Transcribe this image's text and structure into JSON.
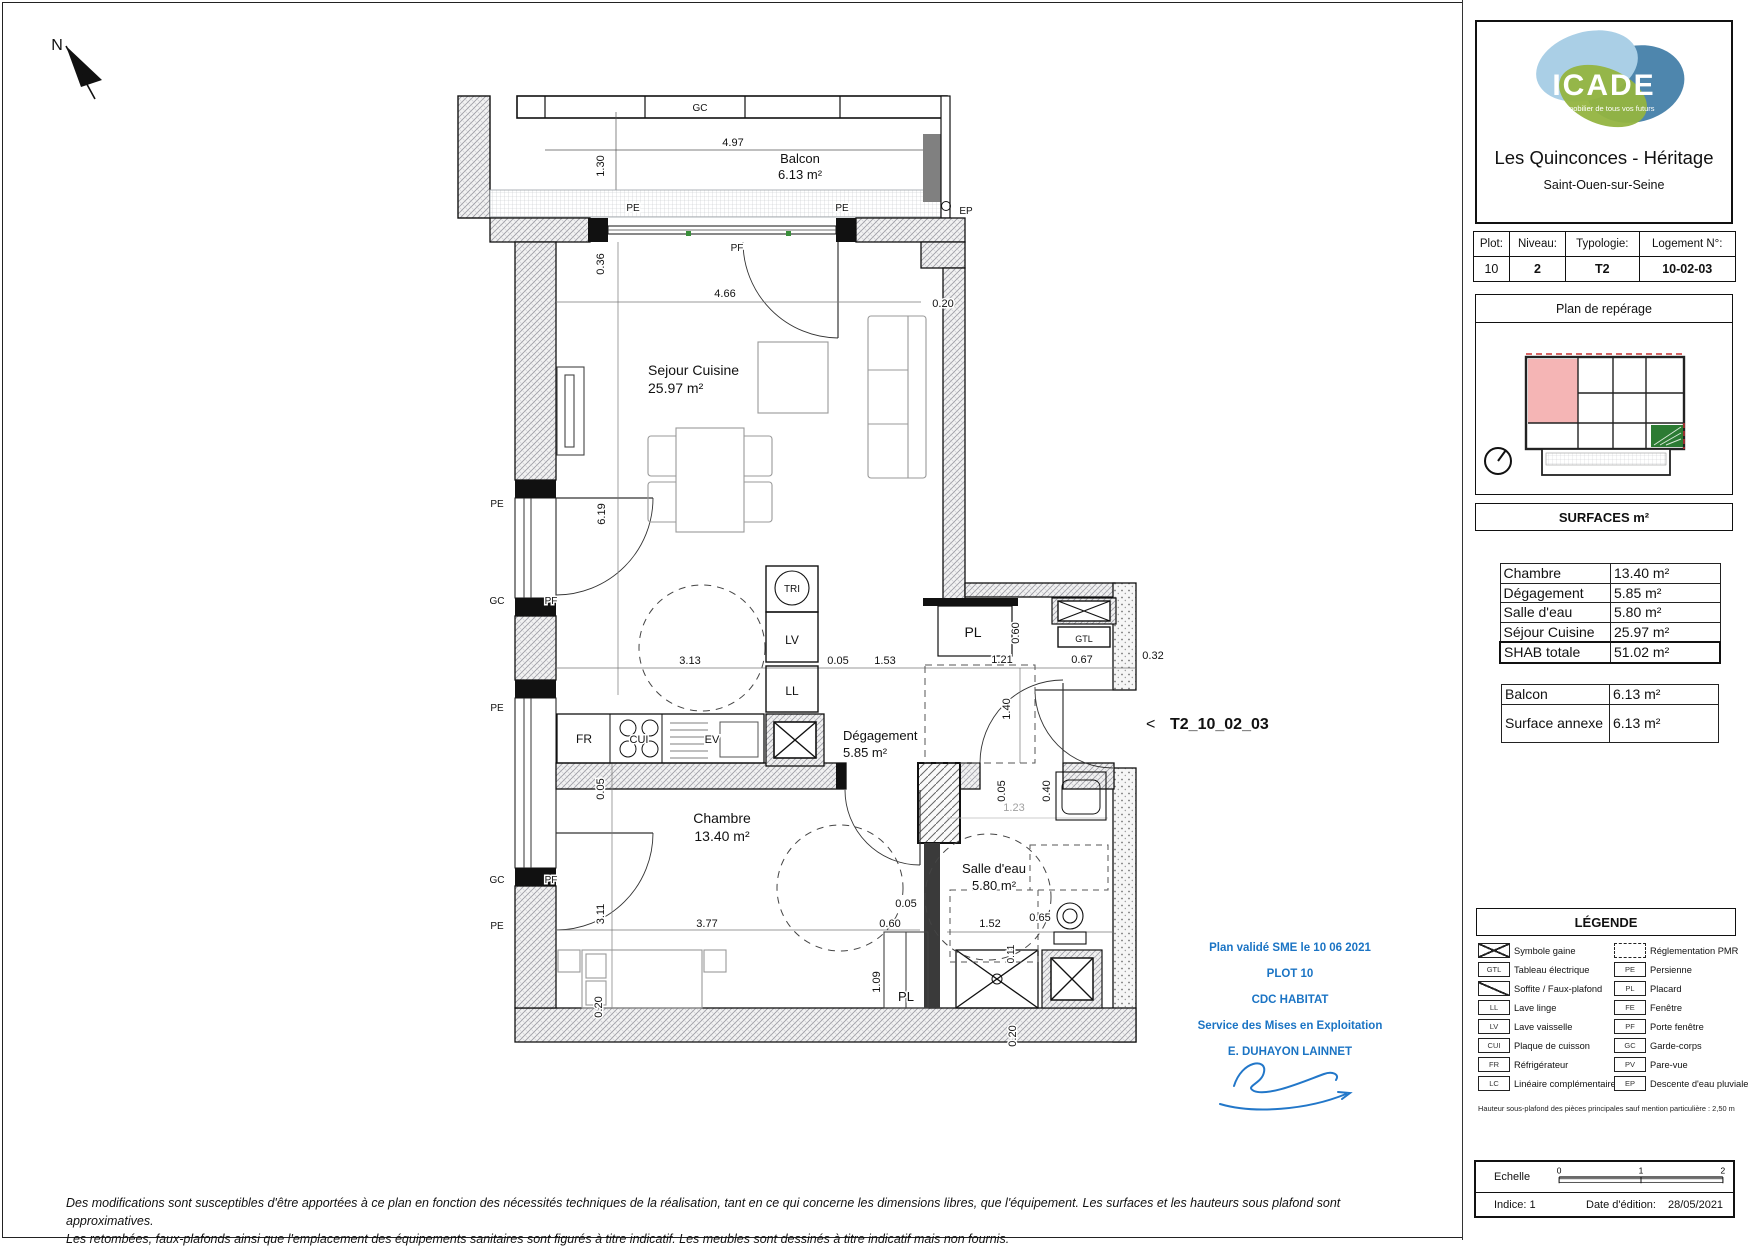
{
  "project": {
    "brand": "ICADE",
    "brand_tagline": "L'immobilier de tous vos futurs",
    "title": "Les Quinconces - Héritage",
    "city": "Saint-Ouen-sur-Seine"
  },
  "unit_table": {
    "headers": [
      "Plot:",
      "Niveau:",
      "Typologie:",
      "Logement N°:"
    ],
    "values": [
      "10",
      "2",
      "T2",
      "10-02-03"
    ]
  },
  "reperage": {
    "title": "Plan de repérage"
  },
  "surfaces": {
    "title": "SURFACES  m²",
    "rows": [
      {
        "label": "Chambre",
        "value": "13.40 m²"
      },
      {
        "label": "Dégagement",
        "value": "5.85 m²"
      },
      {
        "label": "Salle d'eau",
        "value": "5.80 m²"
      },
      {
        "label": "Séjour Cuisine",
        "value": "25.97 m²"
      }
    ],
    "total": {
      "label": "SHAB totale",
      "value": "51.02 m²"
    },
    "annex_rows": [
      {
        "label": "Balcon",
        "value": "6.13 m²"
      },
      {
        "label": "Surface annexe",
        "value": "6.13 m²"
      }
    ]
  },
  "legend": {
    "title": "LÉGENDE",
    "left": [
      {
        "icon": "gaine",
        "label": "Symbole gaine"
      },
      {
        "icon": "GTL",
        "label": "Tableau électrique"
      },
      {
        "icon": "soffite",
        "label": "Soffite / Faux-plafond"
      },
      {
        "icon": "LL",
        "label": "Lave linge"
      },
      {
        "icon": "LV",
        "label": "Lave vaisselle"
      },
      {
        "icon": "CUI",
        "label": "Plaque de cuisson"
      },
      {
        "icon": "FR",
        "label": "Réfrigérateur"
      },
      {
        "icon": "LC",
        "label": "Linéaire complémentaire"
      }
    ],
    "right": [
      {
        "icon": "pmr",
        "label": "Réglementation PMR"
      },
      {
        "icon": "PE",
        "label": "Persienne"
      },
      {
        "icon": "PL",
        "label": "Placard"
      },
      {
        "icon": "FE",
        "label": "Fenêtre"
      },
      {
        "icon": "PF",
        "label": "Porte fenêtre"
      },
      {
        "icon": "GC",
        "label": "Garde-corps"
      },
      {
        "icon": "PV",
        "label": "Pare-vue"
      },
      {
        "icon": "EP",
        "label": "Descente d'eau pluviale"
      }
    ],
    "note": "Hauteur sous-plafond des pièces principales sauf mention particulière : 2,50 m"
  },
  "scalebox": {
    "label": "Echelle",
    "ticks": [
      "0",
      "1",
      "2"
    ],
    "indice": "Indice: 1",
    "date_label": "Date d'édition:",
    "date": "28/05/2021"
  },
  "validation": {
    "lines": [
      "Plan validé SME le 10 06 2021",
      "PLOT 10",
      "CDC HABITAT",
      "Service des Mises en Exploitation",
      "E. DUHAYON LAINNET"
    ]
  },
  "disclaimer": {
    "line1": "Des modifications sont susceptibles d'être apportées à ce plan en fonction des nécessités techniques de la réalisation, tant en ce qui concerne les dimensions libres, que l'équipement. Les surfaces et les hauteurs sous plafond sont approximatives.",
    "line2": "Les retombées, faux-plafonds ainsi que l'emplacement des équipements sanitaires sont figurés à titre indicatif. Les meubles sont dessinés à titre indicatif mais non fournis."
  },
  "plan_labels": [
    {
      "t": "N",
      "x": 57,
      "y": 50,
      "s": 16
    },
    {
      "t": "GC",
      "x": 700,
      "y": 111,
      "s": 10
    },
    {
      "t": "4.97",
      "x": 733,
      "y": 146,
      "s": 11
    },
    {
      "t": "Balcon",
      "x": 800,
      "y": 163,
      "s": 13
    },
    {
      "t": "6.13 m²",
      "x": 800,
      "y": 179,
      "s": 13
    },
    {
      "t": "1.30",
      "x": 604,
      "y": 166,
      "s": 11,
      "r": -90
    },
    {
      "t": "PE",
      "x": 633,
      "y": 211,
      "s": 10
    },
    {
      "t": "PE",
      "x": 842,
      "y": 211,
      "s": 10
    },
    {
      "t": "EP",
      "x": 966,
      "y": 214,
      "s": 10
    },
    {
      "t": "PF",
      "x": 737,
      "y": 251,
      "s": 10
    },
    {
      "t": "0.36",
      "x": 604,
      "y": 264,
      "s": 11,
      "r": -90
    },
    {
      "t": "4.66",
      "x": 725,
      "y": 297,
      "s": 11
    },
    {
      "t": "0.20",
      "x": 943,
      "y": 307,
      "s": 11
    },
    {
      "t": "Sejour Cuisine",
      "x": 648,
      "y": 375,
      "s": 14,
      "a": "start"
    },
    {
      "t": "25.97 m²",
      "x": 648,
      "y": 393,
      "s": 14,
      "a": "start"
    },
    {
      "t": "PE",
      "x": 497,
      "y": 507,
      "s": 10
    },
    {
      "t": "6.19",
      "x": 605,
      "y": 514,
      "s": 11,
      "r": -90
    },
    {
      "t": "GC",
      "x": 497,
      "y": 604,
      "s": 10
    },
    {
      "t": "PF",
      "x": 551,
      "y": 604,
      "s": 10
    },
    {
      "t": "TRI",
      "x": 792,
      "y": 592,
      "s": 10
    },
    {
      "t": "LV",
      "x": 792,
      "y": 644,
      "s": 12
    },
    {
      "t": "LL",
      "x": 792,
      "y": 695,
      "s": 12
    },
    {
      "t": "PL",
      "x": 973,
      "y": 637,
      "s": 14
    },
    {
      "t": "0.60",
      "x": 1019,
      "y": 633,
      "s": 11,
      "r": -90
    },
    {
      "t": "GTL",
      "x": 1084,
      "y": 642,
      "s": 9
    },
    {
      "t": "3.13",
      "x": 690,
      "y": 664,
      "s": 11
    },
    {
      "t": "0.05",
      "x": 838,
      "y": 664,
      "s": 11
    },
    {
      "t": "1.53",
      "x": 885,
      "y": 664,
      "s": 11
    },
    {
      "t": "1.21",
      "x": 1002,
      "y": 663,
      "s": 11
    },
    {
      "t": "0.67",
      "x": 1082,
      "y": 663,
      "s": 11
    },
    {
      "t": "0.32",
      "x": 1153,
      "y": 659,
      "s": 11
    },
    {
      "t": "PE",
      "x": 497,
      "y": 711,
      "s": 10
    },
    {
      "t": "FR",
      "x": 584,
      "y": 743,
      "s": 12
    },
    {
      "t": "CUI",
      "x": 639,
      "y": 743,
      "s": 11
    },
    {
      "t": "EV",
      "x": 712,
      "y": 743,
      "s": 11
    },
    {
      "t": "Dégagement",
      "x": 843,
      "y": 740,
      "s": 13,
      "a": "start"
    },
    {
      "t": "5.85 m²",
      "x": 843,
      "y": 757,
      "s": 13,
      "a": "start"
    },
    {
      "t": "1.40",
      "x": 1010,
      "y": 709,
      "s": 11,
      "r": -90
    },
    {
      "t": "0.05",
      "x": 1005,
      "y": 791,
      "s": 11,
      "r": -90
    },
    {
      "t": "0.40",
      "x": 1050,
      "y": 791,
      "s": 11,
      "r": -90
    },
    {
      "t": "1.23",
      "x": 1014,
      "y": 811,
      "s": 11,
      "c": "#a0a0a0"
    },
    {
      "t": "0.05",
      "x": 604,
      "y": 789,
      "s": 11,
      "r": -90
    },
    {
      "t": "GC",
      "x": 497,
      "y": 883,
      "s": 10
    },
    {
      "t": "PF",
      "x": 551,
      "y": 883,
      "s": 10
    },
    {
      "t": "Chambre",
      "x": 722,
      "y": 823,
      "s": 14
    },
    {
      "t": "13.40 m²",
      "x": 722,
      "y": 841,
      "s": 14
    },
    {
      "t": "Salle d'eau",
      "x": 994,
      "y": 873,
      "s": 13
    },
    {
      "t": "5.80 m²",
      "x": 994,
      "y": 890,
      "s": 13
    },
    {
      "t": "3.11",
      "x": 604,
      "y": 914,
      "s": 11,
      "r": -90
    },
    {
      "t": "PE",
      "x": 497,
      "y": 929,
      "s": 10
    },
    {
      "t": "0.05",
      "x": 906,
      "y": 907,
      "s": 11
    },
    {
      "t": "0.60",
      "x": 890,
      "y": 927,
      "s": 11
    },
    {
      "t": "3.77",
      "x": 707,
      "y": 927,
      "s": 11
    },
    {
      "t": "1.52",
      "x": 990,
      "y": 927,
      "s": 11
    },
    {
      "t": "0.65",
      "x": 1040,
      "y": 921,
      "s": 11
    },
    {
      "t": "0.11",
      "x": 1014,
      "y": 954,
      "s": 10,
      "r": -90
    },
    {
      "t": "1.09",
      "x": 880,
      "y": 982,
      "s": 11,
      "r": -90
    },
    {
      "t": "PL",
      "x": 906,
      "y": 1001,
      "s": 13
    },
    {
      "t": "0.20",
      "x": 602,
      "y": 1007,
      "s": 11,
      "r": -90
    },
    {
      "t": "0.20",
      "x": 1016,
      "y": 1036,
      "s": 11,
      "r": -90
    },
    {
      "t": "<",
      "x": 1146,
      "y": 729,
      "s": 16,
      "a": "start"
    },
    {
      "t": "T2_10_02_03",
      "x": 1170,
      "y": 729,
      "s": 16,
      "b": 1,
      "a": "start"
    }
  ]
}
